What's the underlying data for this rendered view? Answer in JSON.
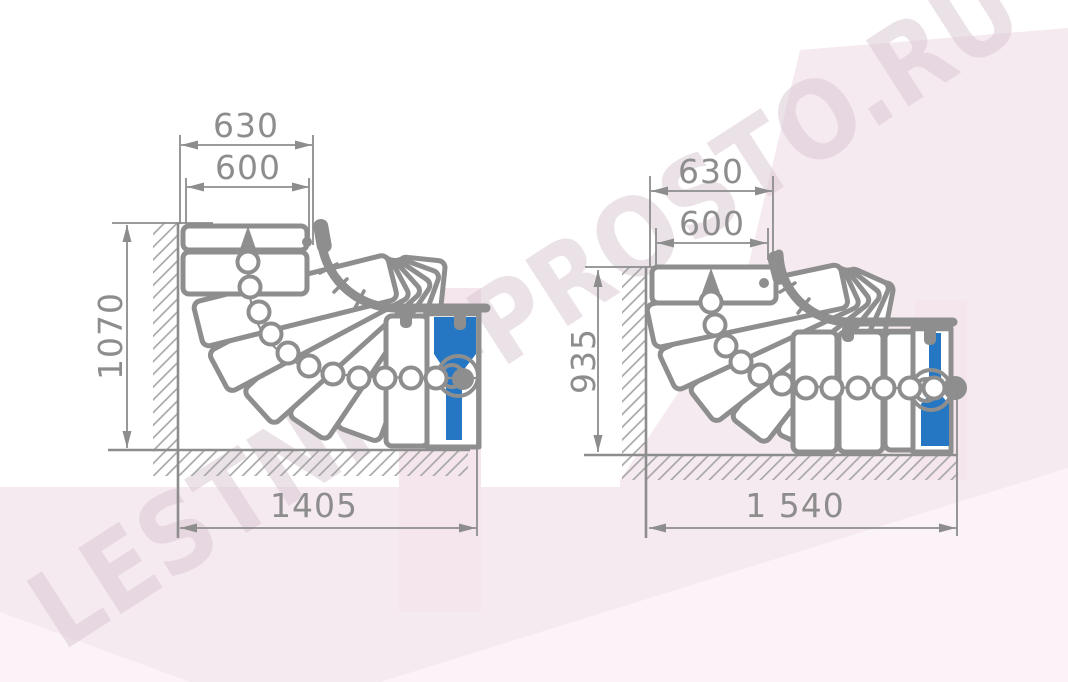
{
  "watermark": {
    "text": "LESTNICI-PROSTO.RU"
  },
  "colors": {
    "line_gray": "#8e8e8e",
    "dim_gray": "#8d8d8d",
    "accent_blue": "#2577c4",
    "bg_pink": "#f6eaf1",
    "bg_pink_light": "#fbf3f8",
    "highlight_pink": "#f5e6ee",
    "watermark": "#d9c6d2"
  },
  "views": {
    "left": {
      "outer_width": "630",
      "inner_width": "600",
      "height": "1070",
      "total_length": "1405"
    },
    "right": {
      "outer_width": "630",
      "inner_width": "600",
      "height": "935",
      "total_length": "1 540"
    }
  }
}
